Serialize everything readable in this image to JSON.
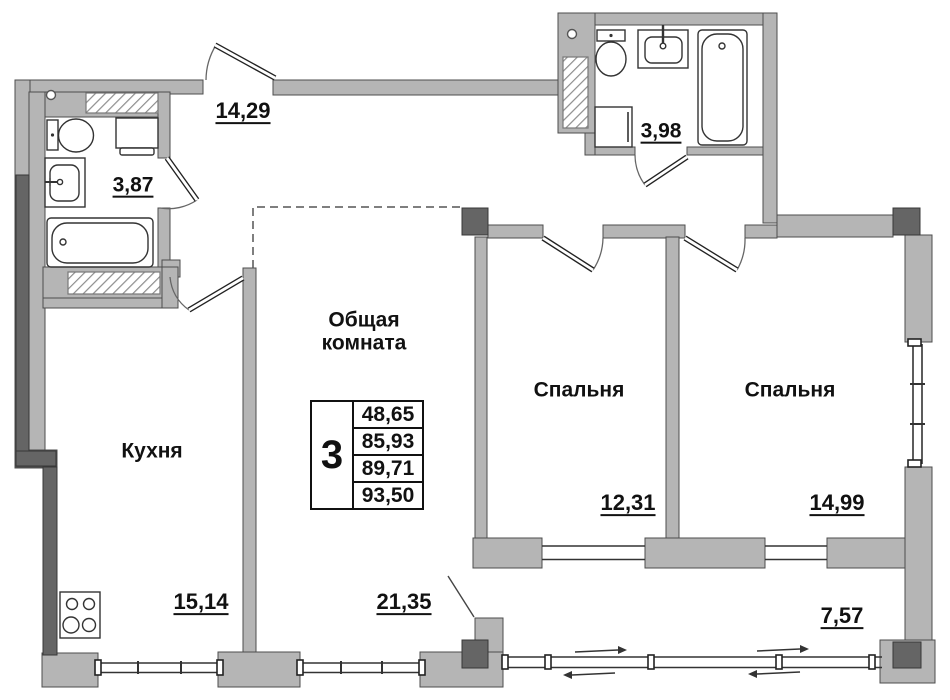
{
  "rooms": {
    "hall": {
      "area": "14,29"
    },
    "bathroom1": {
      "area": "3,87"
    },
    "bathroom2": {
      "area": "3,98"
    },
    "living": {
      "name_line1": "Общая",
      "name_line2": "комната",
      "area": "21,35"
    },
    "kitchen": {
      "name": "Кухня",
      "area": "15,14"
    },
    "bedroom1": {
      "name": "Спальня",
      "area": "12,31"
    },
    "bedroom2": {
      "name": "Спальня",
      "area": "14,99"
    },
    "balcony": {
      "area": "7,57"
    }
  },
  "apartment_table": {
    "rooms_count": "3",
    "areas": [
      "48,65",
      "85,93",
      "89,71",
      "93,50"
    ]
  },
  "colors": {
    "wall_fill": "#b5b5b5",
    "wall_outline": "#4d4d4d",
    "wall_dark": "#656565",
    "background": "#ffffff",
    "text": "#111111"
  }
}
